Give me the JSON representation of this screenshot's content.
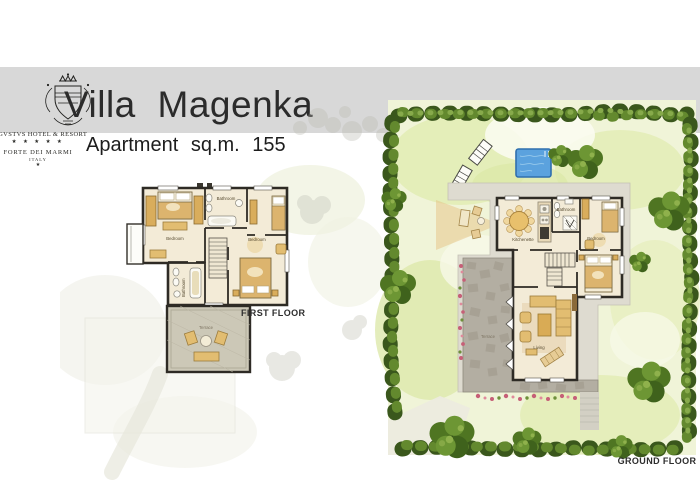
{
  "header": {
    "title": "Villa Magenka",
    "subtitle": "Apartment sq.m. 155"
  },
  "logo": {
    "hotel_name": "AVGVSTVS HOTEL & RESORT",
    "stars": "★ ★ ★ ★ ★",
    "location": "FORTE DEI MARMI",
    "country": "ITALY",
    "mark": "★"
  },
  "first_floor": {
    "label": "FIRST FLOOR",
    "rooms": {
      "bedroom_left": "Bedroom",
      "bathroom_top": "Bathroom",
      "bedroom_right": "Bedroom",
      "bathroom_lower": "Bathroom",
      "terrace": "Terrace"
    }
  },
  "ground_floor": {
    "label": "GROUND FLOOR",
    "rooms": {
      "kitchenette": "Kitchenette",
      "bathroom": "Bathroom",
      "bedroom": "Bedroom",
      "living": "Living",
      "terrace": "Terrace"
    }
  },
  "colors": {
    "header_band": "#d8d8d8",
    "wall": "#2e2b25",
    "floor": "#f3ebd7",
    "furniture_tan": "#e2bd71",
    "garden_base": "#f0f4d8",
    "hedge_dark": "#3a571c",
    "hedge_mid": "#63892e",
    "pool_blue": "#5ba2de",
    "stone_terrace": "#b3aea2"
  }
}
